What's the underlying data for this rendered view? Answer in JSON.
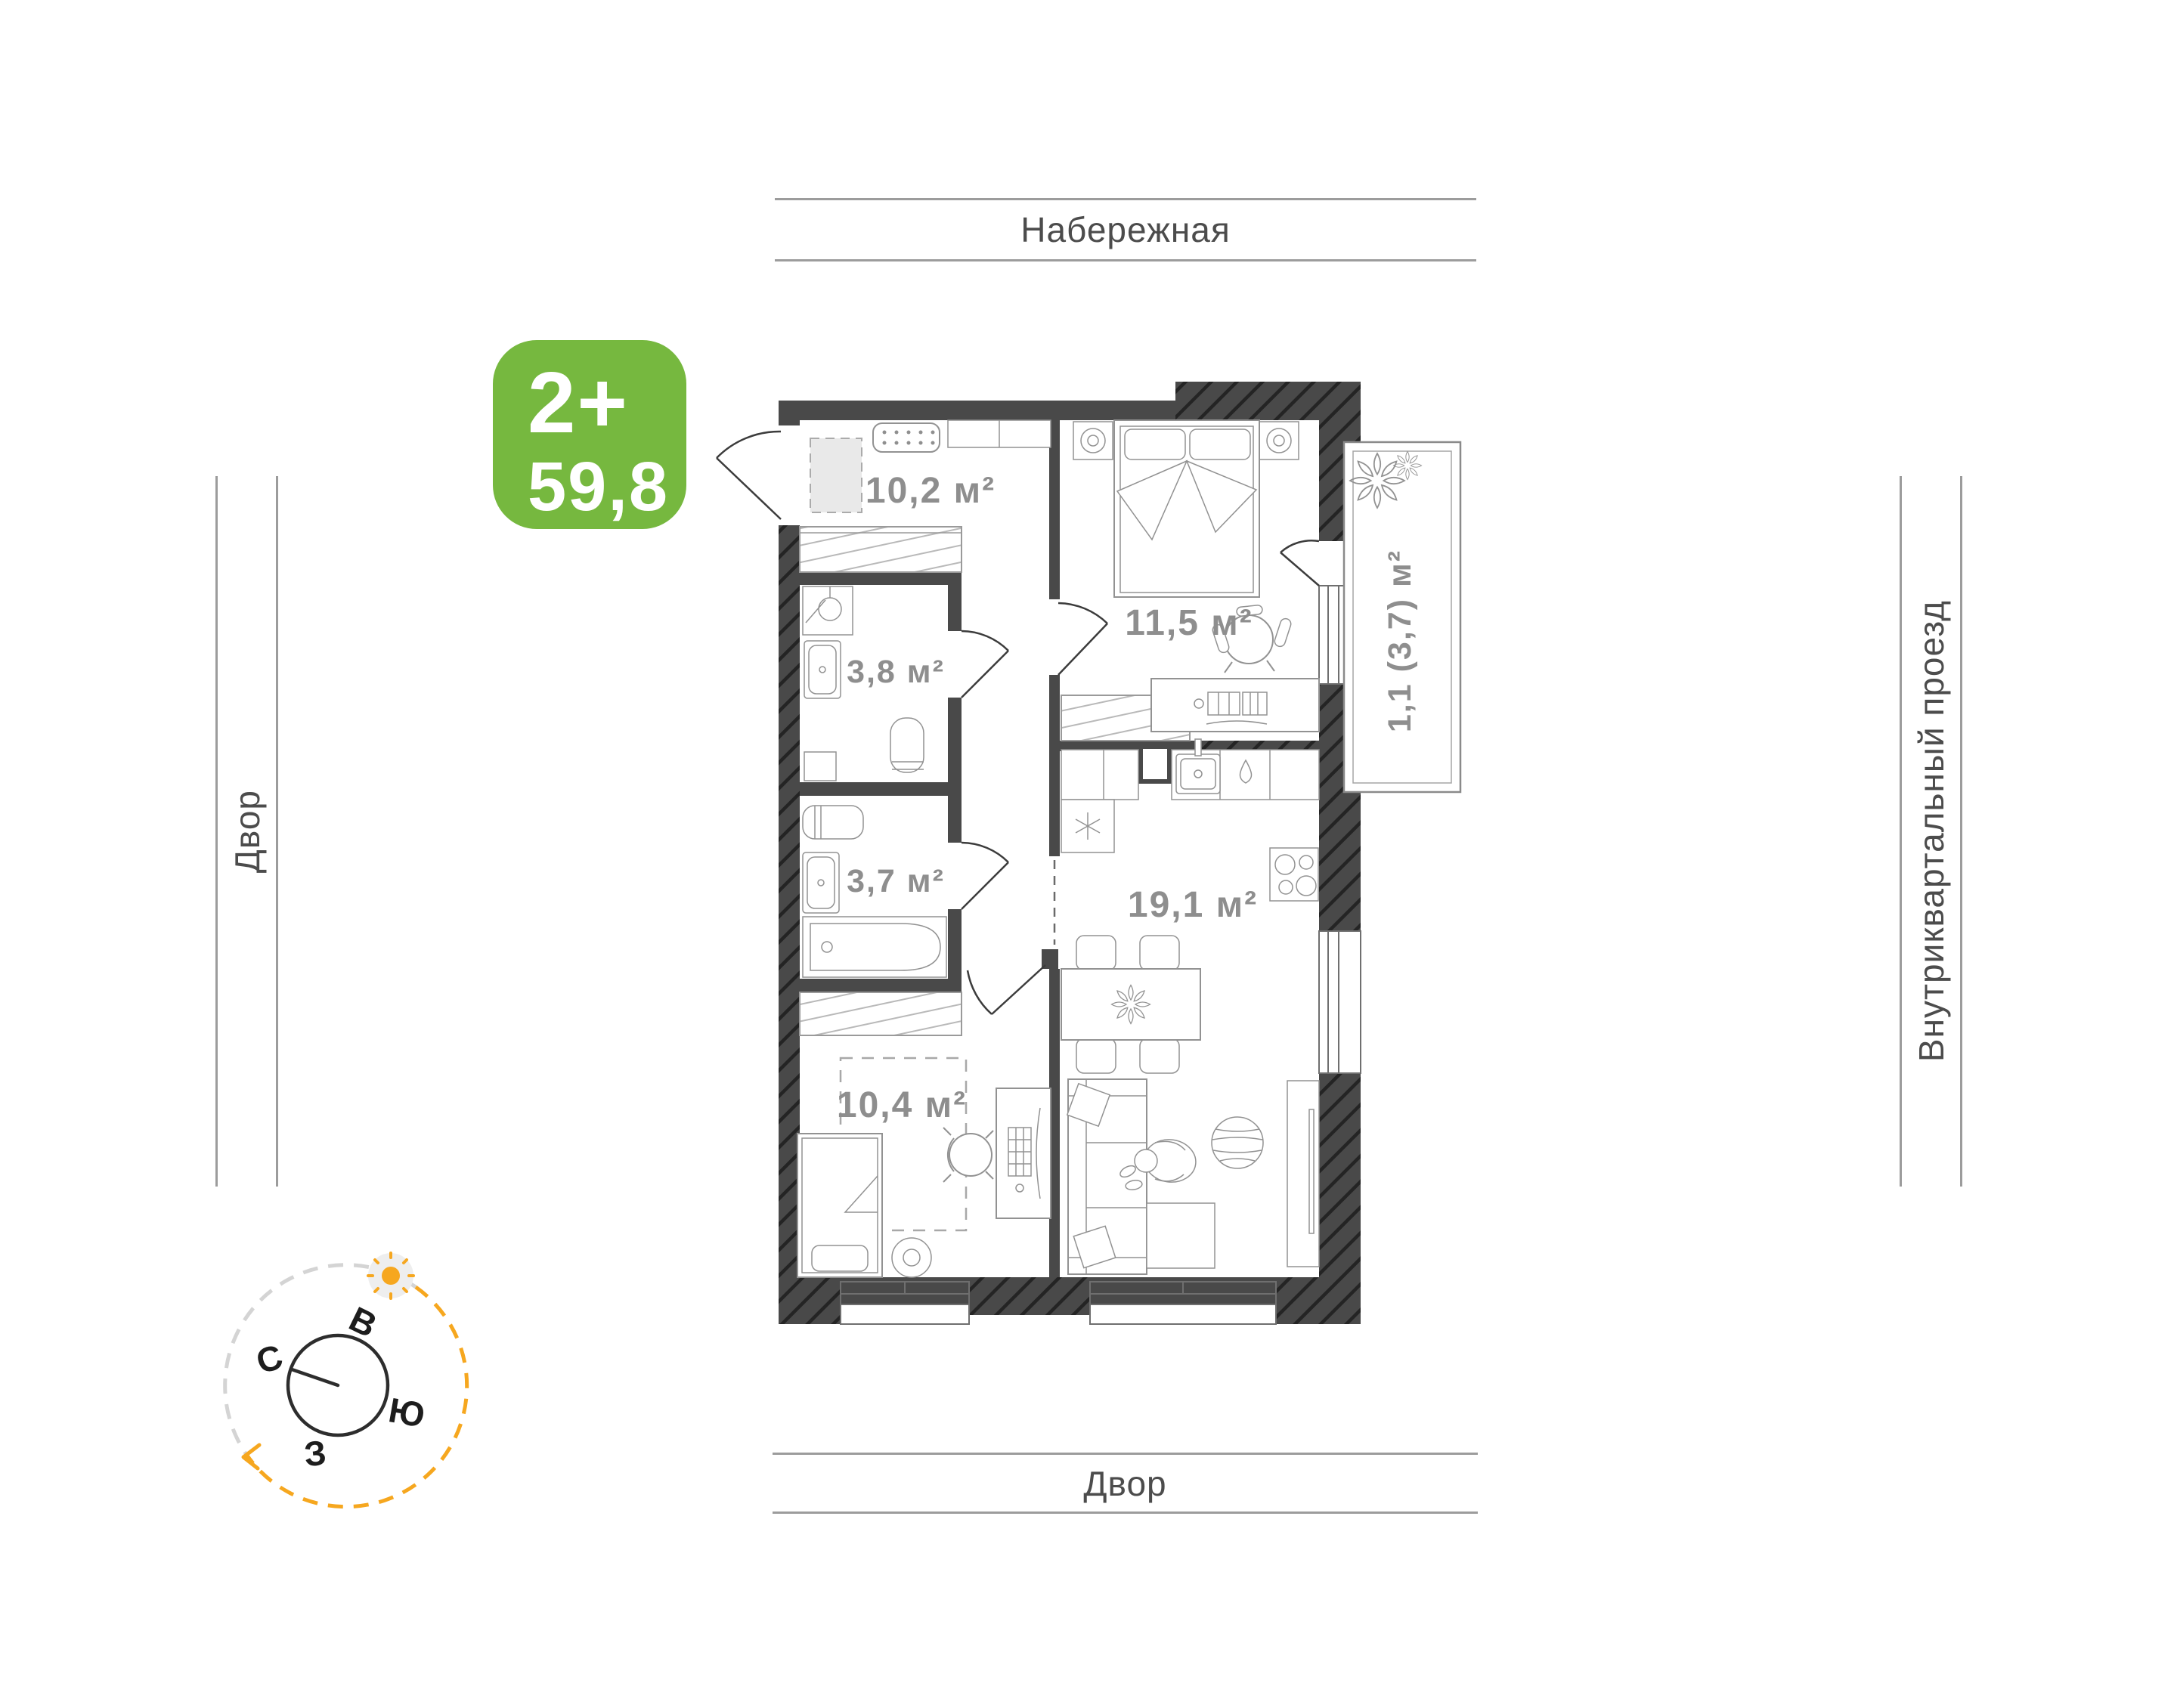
{
  "surroundings": {
    "top": "Набережная",
    "bottom": "Двор",
    "left": "Двор",
    "right": "Внутриквартальный проезд"
  },
  "badge": {
    "type": "2+",
    "area": "59,8"
  },
  "rooms": {
    "hallway": "10,2 м²",
    "bedroom_main": "11,5 м²",
    "bathroom": "3,8 м²",
    "bathroom_second": "3,7 м²",
    "kitchen_living": "19,1 м²",
    "bedroom_second": "10,4 м²",
    "balcony": "1,1 (3,7) м²"
  },
  "compass": {
    "north": "С",
    "east": "В",
    "south": "Ю",
    "west": "З"
  },
  "colors": {
    "badge_green": "#76b83f",
    "wall_dark": "#494949",
    "area_label_gray": "#8e8e8e",
    "street_label_gray": "#4c4c4c",
    "street_line_gray": "#9c9c9c",
    "compass_orange": "#f6a71f"
  }
}
